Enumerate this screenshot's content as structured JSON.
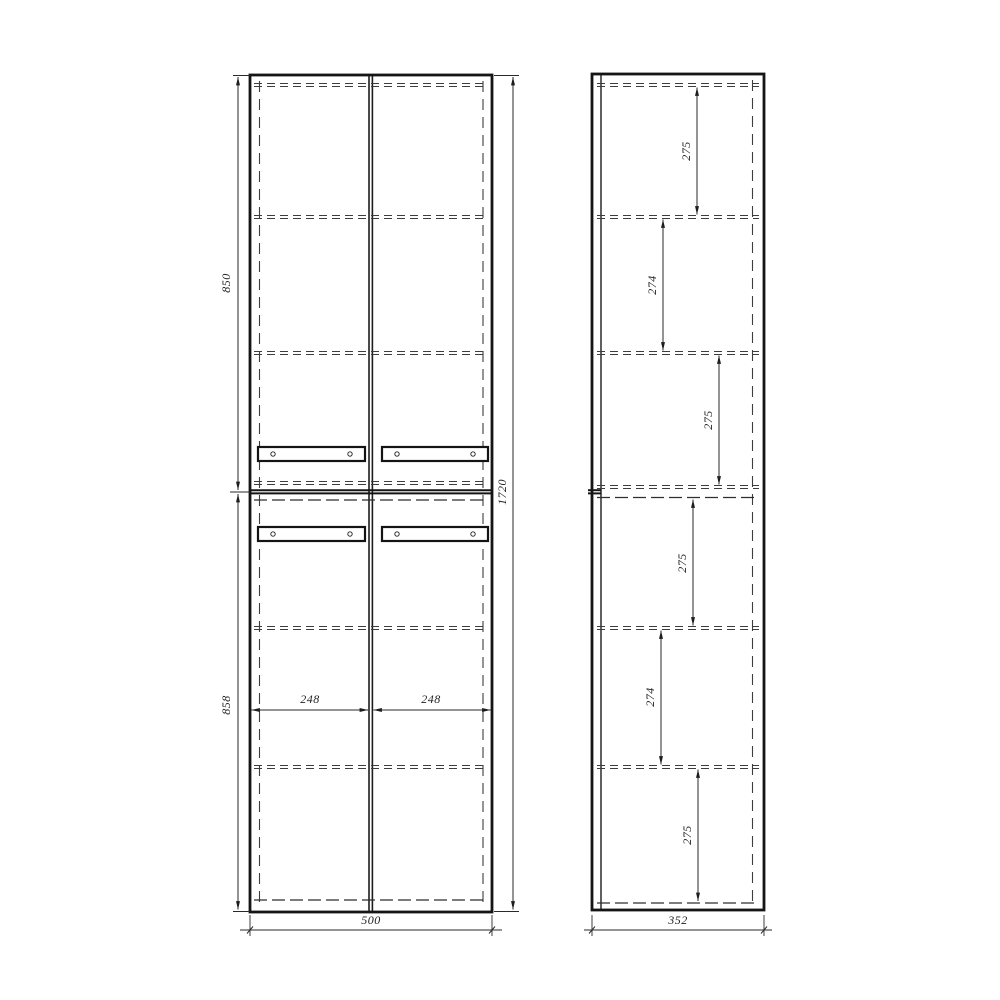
{
  "drawing": {
    "type": "furniture-technical-drawing",
    "front_view": {
      "door_height_top": "850",
      "door_height_bottom": "858",
      "total_height": "1720",
      "door_width_left": "248",
      "door_width_right": "248",
      "total_width": "500"
    },
    "side_view": {
      "shelf_spacings": [
        "275",
        "274",
        "275",
        "275",
        "274",
        "275"
      ],
      "total_depth": "352"
    },
    "colors": {
      "line": "#151515",
      "dashed": "#3d3d3d",
      "dimension": "#2a2a2a",
      "background": "#ffffff"
    }
  }
}
